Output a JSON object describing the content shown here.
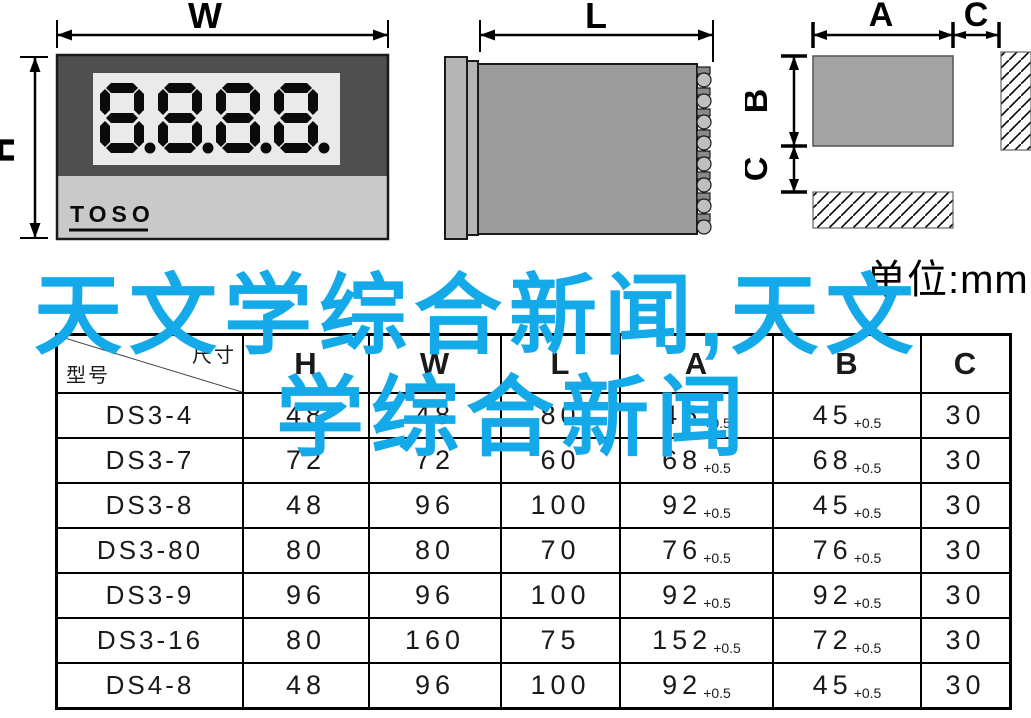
{
  "drawings": {
    "front_view": {
      "dim_width_label": "W",
      "dim_height_label": "H",
      "display_value": "8.8.8.8.",
      "brand": "TOSO",
      "bezel_color": "#4f4f4f",
      "panel_color": "#c9c9c9",
      "window_color": "#eaeaea"
    },
    "side_view": {
      "dim_length_label": "L",
      "body_color": "#9c9c9c",
      "flange_color": "#b5b5b5"
    },
    "cutout_view": {
      "dim_a_label": "A",
      "dim_c_top_label": "C",
      "dim_b_label": "B",
      "dim_c_left_label": "C",
      "cutout_color": "#a3a3a3"
    }
  },
  "unit_label": "单位:mm",
  "overlay": {
    "line1": "天文学综合新闻,天文",
    "line2": "学综合新闻",
    "color": "#14aae9"
  },
  "table": {
    "corner": {
      "top_right": "尺寸",
      "bottom_left": "型号"
    },
    "columns": [
      "H",
      "W",
      "L",
      "A",
      "B",
      "C"
    ],
    "rows": [
      {
        "model": "DS3-4",
        "h": "48",
        "w": "48",
        "l": "80",
        "a": "45",
        "a_tol": "+0.5",
        "b": "45",
        "b_tol": "+0.5",
        "c": "30"
      },
      {
        "model": "DS3-7",
        "h": "72",
        "w": "72",
        "l": "60",
        "a": "68",
        "a_tol": "+0.5",
        "b": "68",
        "b_tol": "+0.5",
        "c": "30"
      },
      {
        "model": "DS3-8",
        "h": "48",
        "w": "96",
        "l": "100",
        "a": "92",
        "a_tol": "+0.5",
        "b": "45",
        "b_tol": "+0.5",
        "c": "30"
      },
      {
        "model": "DS3-80",
        "h": "80",
        "w": "80",
        "l": "70",
        "a": "76",
        "a_tol": "+0.5",
        "b": "76",
        "b_tol": "+0.5",
        "c": "30"
      },
      {
        "model": "DS3-9",
        "h": "96",
        "w": "96",
        "l": "100",
        "a": "92",
        "a_tol": "+0.5",
        "b": "92",
        "b_tol": "+0.5",
        "c": "30"
      },
      {
        "model": "DS3-16",
        "h": "80",
        "w": "160",
        "l": "75",
        "a": "152",
        "a_tol": "+0.5",
        "b": "72",
        "b_tol": "+0.5",
        "c": "30"
      },
      {
        "model": "DS4-8",
        "h": "48",
        "w": "96",
        "l": "100",
        "a": "92",
        "a_tol": "+0.5",
        "b": "45",
        "b_tol": "+0.5",
        "c": "30"
      }
    ]
  }
}
